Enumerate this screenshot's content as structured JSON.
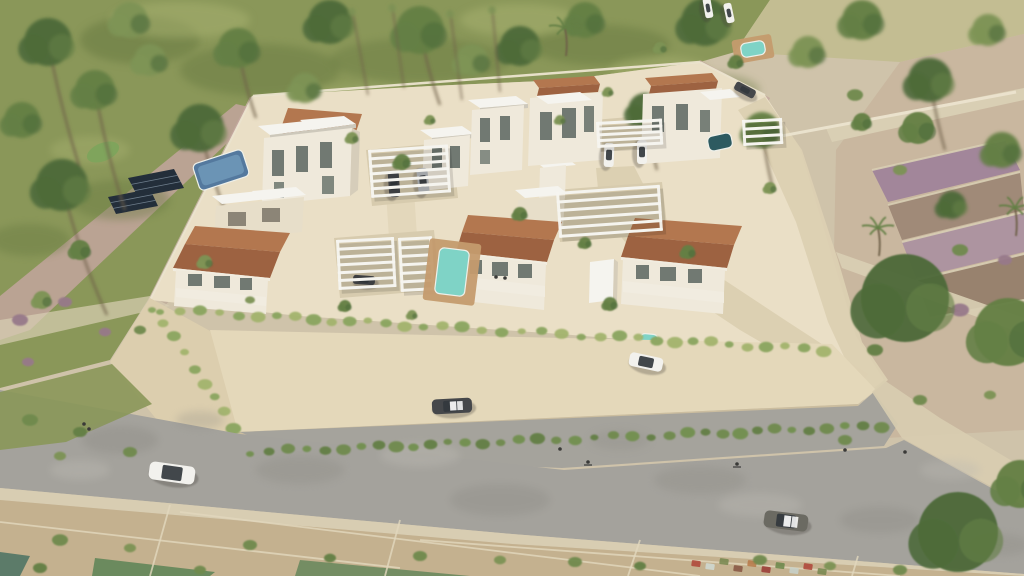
{
  "meta": {
    "scene_type": "architectural-aerial-render",
    "content_text": ""
  },
  "palette": {
    "base": "#cfc3aa",
    "grass": "#8a9759",
    "grassDark": "#66783f",
    "grassLight": "#a9b271",
    "dryField": "#c3bd92",
    "sand": "#c9b79f",
    "sandLight": "#d8cdb0",
    "dirt": "#bfae9b",
    "pink": "#c2a59e",
    "mauve": "#a2869a",
    "terraceBrown": "#a08a78",
    "terraceMauve": "#ad94a0",
    "terraceDark": "#98826e",
    "stone": "#d9cfb4",
    "platform": "#eadfc6",
    "pathLight": "#e3d7bb",
    "drivePath": "#dcd0b2",
    "pad": "#d7cbae",
    "wallCream": "#e4d8ba",
    "wallCreamDark": "#dcceae",
    "wallShade": "#c9bb9c",
    "road": "#a4a29c",
    "roadDark": "#8b8983",
    "roadLight": "#bcb9b2",
    "sidewalk": "#d8cdb2",
    "plots": "#c4b18f",
    "plotLine": "#e2d8be",
    "teal1": "#5c7b69",
    "teal2": "#6b8a5e",
    "white": "#f5f4ef",
    "slabShadow": "#cdc8bb",
    "wallWhite": "#efe9db",
    "wallSide": "#d6cdba",
    "win": "#5a655f",
    "tt": "#b3774f",
    "ttDark": "#9d6241",
    "eave": "#f1ece0",
    "cream": "#e7dec9",
    "door": "#8c8577",
    "poolBlue": "#54799e",
    "poolBlueIn": "#7099b8",
    "poolT": "#7fd3c6",
    "poolTDark": "#2d5a60",
    "deck": "#c49b6e",
    "treeDark": "#4d6a3a",
    "treeMid": "#647f45",
    "treeOlive": "#7d9355",
    "shrub": "#6f8a4e",
    "plant1": "#8aa55f",
    "plant2": "#a3b46d",
    "hedge": "#72904f",
    "trunk": "#6f5f49",
    "mauveShrub": "#97798a",
    "solar": "#232e3a",
    "carDark": "#45474a",
    "carSilver": "#b9bcc0",
    "carWhite": "#f2f1ed",
    "carGray": "#6b6a62",
    "cabin": "#33383d",
    "figure": "#3a3a38",
    "lawn": "#7fa45c"
  },
  "scene": {
    "bgTrees": [
      [
        48,
        42,
        24,
        "treeDark",
        40,
        150
      ],
      [
        22,
        120,
        18,
        "treeMid"
      ],
      [
        95,
        90,
        20,
        "treeMid",
        30,
        120
      ],
      [
        62,
        185,
        26,
        "treeDark",
        45,
        130
      ],
      [
        150,
        60,
        16,
        "treeOlive"
      ],
      [
        200,
        128,
        24,
        "treeDark",
        28,
        90
      ],
      [
        238,
        48,
        20,
        "treeMid",
        18,
        70
      ],
      [
        305,
        88,
        15,
        "treeOlive"
      ],
      [
        330,
        22,
        22,
        "treeDark"
      ],
      [
        420,
        30,
        24,
        "treeMid",
        20,
        75
      ],
      [
        472,
        60,
        16,
        "treeOlive"
      ],
      [
        520,
        46,
        20,
        "treeDark"
      ],
      [
        585,
        20,
        18,
        "treeMid"
      ],
      [
        645,
        110,
        17,
        "treeDark",
        12,
        60
      ],
      [
        705,
        22,
        24,
        "treeDark"
      ],
      [
        762,
        130,
        18,
        "treeMid",
        10,
        55
      ],
      [
        808,
        52,
        16,
        "treeOlive"
      ],
      [
        862,
        20,
        20,
        "treeMid"
      ],
      [
        930,
        80,
        22,
        "treeDark",
        15,
        70
      ],
      [
        988,
        30,
        16,
        "treeOlive"
      ],
      [
        1002,
        150,
        18,
        "treeMid"
      ],
      [
        952,
        205,
        14,
        "treeDark"
      ],
      [
        130,
        20,
        18,
        "treeOlive"
      ],
      [
        680,
        140,
        12,
        "treeOlive"
      ]
    ],
    "fgTrees": [
      [
        402,
        162,
        8,
        "treeMid"
      ],
      [
        352,
        138,
        6,
        "treeOlive"
      ],
      [
        430,
        120,
        5,
        "treeOlive"
      ],
      [
        520,
        214,
        7,
        "treeMid"
      ],
      [
        560,
        120,
        5,
        "treeOlive"
      ],
      [
        585,
        243,
        6,
        "treeMid"
      ],
      [
        688,
        252,
        7,
        "treeMid"
      ],
      [
        770,
        188,
        6,
        "treeOlive"
      ],
      [
        736,
        62,
        7,
        "treeMid"
      ],
      [
        660,
        48,
        6,
        "treeOlive"
      ],
      [
        608,
        92,
        5,
        "treeOlive"
      ],
      [
        345,
        306,
        6,
        "treeMid"
      ],
      [
        610,
        304,
        7,
        "treeMid"
      ],
      [
        412,
        315,
        5,
        "treeOlive"
      ],
      [
        905,
        298,
        44,
        "treeDark"
      ],
      [
        1008,
        332,
        34,
        "treeMid"
      ],
      [
        958,
        532,
        40,
        "treeDark"
      ],
      [
        1020,
        484,
        24,
        "treeMid"
      ],
      [
        862,
        122,
        9,
        "treeMid"
      ],
      [
        80,
        250,
        10,
        "treeMid"
      ],
      [
        42,
        300,
        9,
        "treeOlive"
      ],
      [
        205,
        262,
        7,
        "treeOlive"
      ],
      [
        918,
        128,
        16,
        "treeMid"
      ]
    ],
    "palms": [
      [
        565,
        28
      ],
      [
        878,
        228
      ],
      [
        1015,
        208
      ]
    ],
    "cypress": [
      [
        352,
        8,
        368,
        95
      ],
      [
        392,
        4,
        404,
        88
      ],
      [
        450,
        10,
        462,
        100
      ],
      [
        492,
        6,
        500,
        92
      ]
    ],
    "grassPatches": [
      [
        140,
        40,
        60,
        24,
        "grassDark",
        0.5
      ],
      [
        260,
        70,
        80,
        26,
        "grassDark",
        0.45
      ],
      [
        420,
        60,
        90,
        22,
        "grassDark",
        0.4
      ],
      [
        600,
        45,
        70,
        20,
        "grassDark",
        0.45
      ],
      [
        120,
        200,
        50,
        20,
        "grassDark",
        0.4
      ],
      [
        30,
        240,
        40,
        16,
        "grassDark",
        0.4
      ],
      [
        700,
        90,
        60,
        18,
        "grassDark",
        0.35
      ],
      [
        180,
        20,
        70,
        18,
        "grassLight",
        0.5
      ],
      [
        520,
        20,
        60,
        16,
        "grassLight",
        0.5
      ],
      [
        660,
        70,
        50,
        14,
        "grassLight",
        0.45
      ],
      [
        90,
        150,
        40,
        14,
        "grassLight",
        0.4
      ],
      [
        360,
        100,
        60,
        16,
        "grassLight",
        0.35
      ]
    ],
    "mottle": [
      [
        120,
        440,
        38,
        14,
        "roadDark",
        0.35
      ],
      [
        300,
        470,
        44,
        14,
        "roadDark",
        0.3
      ],
      [
        500,
        500,
        50,
        16,
        "roadDark",
        0.32
      ],
      [
        700,
        480,
        46,
        14,
        "roadDark",
        0.3
      ],
      [
        880,
        520,
        40,
        13,
        "roadDark",
        0.33
      ],
      [
        1000,
        545,
        30,
        11,
        "roadDark",
        0.3
      ],
      [
        200,
        420,
        24,
        9,
        "roadDark",
        0.25
      ],
      [
        620,
        440,
        30,
        10,
        "roadDark",
        0.25
      ],
      [
        420,
        455,
        40,
        12,
        "roadLight",
        0.4
      ],
      [
        760,
        505,
        42,
        12,
        "roadLight",
        0.38
      ],
      [
        950,
        470,
        30,
        10,
        "roadLight",
        0.35
      ],
      [
        80,
        470,
        30,
        10,
        "roadLight",
        0.4
      ]
    ],
    "wallPlantRows": [
      {
        "x1": 160,
        "y1": 306,
        "x2": 826,
        "y2": 346,
        "n": 36,
        "dy": 4
      },
      {
        "x1": 152,
        "y1": 306,
        "x2": 232,
        "y2": 426,
        "n": 9,
        "dy": 2
      }
    ],
    "hedgeRow": {
      "x1": 250,
      "y1": 452,
      "x2": 884,
      "y2": 426,
      "n": 36
    },
    "shrubs": [
      [
        60,
        540,
        8,
        "shrub"
      ],
      [
        130,
        548,
        6,
        "treeOlive"
      ],
      [
        250,
        545,
        7,
        "shrub"
      ],
      [
        330,
        558,
        6,
        "treeMid"
      ],
      [
        420,
        556,
        7,
        "shrub"
      ],
      [
        500,
        560,
        6,
        "treeOlive"
      ],
      [
        575,
        562,
        7,
        "shrub"
      ],
      [
        640,
        566,
        6,
        "treeMid"
      ],
      [
        760,
        560,
        7,
        "shrub"
      ],
      [
        830,
        566,
        6,
        "treeOlive"
      ],
      [
        900,
        570,
        7,
        "shrub"
      ],
      [
        40,
        568,
        7,
        "treeMid"
      ],
      [
        200,
        570,
        6,
        "shrub"
      ],
      [
        30,
        420,
        8,
        "shrub"
      ],
      [
        80,
        432,
        7,
        "treeMid"
      ],
      [
        130,
        452,
        7,
        "shrub"
      ],
      [
        60,
        456,
        6,
        "treeOlive"
      ],
      [
        855,
        95,
        8,
        "shrub"
      ],
      [
        900,
        170,
        7,
        "treeOlive"
      ],
      [
        960,
        250,
        8,
        "shrub"
      ],
      [
        875,
        350,
        8,
        "treeMid"
      ],
      [
        920,
        400,
        7,
        "shrub"
      ],
      [
        990,
        395,
        6,
        "treeOlive"
      ],
      [
        845,
        440,
        7,
        "shrub"
      ],
      [
        20,
        320,
        8,
        "mauveShrub"
      ],
      [
        65,
        302,
        7,
        "mauveShrub"
      ],
      [
        105,
        332,
        6,
        "mauveShrub"
      ],
      [
        140,
        330,
        6,
        "shrub"
      ],
      [
        28,
        362,
        6,
        "mauveShrub"
      ],
      [
        250,
        300,
        5,
        "treeOlive"
      ],
      [
        960,
        310,
        9,
        "mauveShrub"
      ],
      [
        1005,
        260,
        7,
        "mauveShrub"
      ]
    ],
    "clutter": [
      [
        692,
        560,
        "#b04a3c"
      ],
      [
        706,
        563,
        "#cfd8d0"
      ],
      [
        720,
        558,
        "#7a8a52"
      ],
      [
        734,
        565,
        "#8a5a46"
      ],
      [
        748,
        560,
        "#b87c4c"
      ],
      [
        762,
        566,
        "#9c3f38"
      ],
      [
        776,
        562,
        "#6f8a4e"
      ],
      [
        790,
        567,
        "#c8d0c8"
      ],
      [
        804,
        563,
        "#b04a3c"
      ],
      [
        818,
        568,
        "#7a8a52"
      ]
    ],
    "plotLines": [
      [
        0,
        522,
        400,
        568
      ],
      [
        180,
        512,
        700,
        576
      ],
      [
        420,
        540,
        900,
        576
      ],
      [
        170,
        505,
        150,
        576
      ],
      [
        400,
        520,
        385,
        576
      ],
      [
        640,
        540,
        628,
        576
      ],
      [
        858,
        556,
        852,
        576
      ]
    ],
    "boundaryLines": [
      [
        253,
        96,
        700,
        62,
        2.5
      ],
      [
        150,
        300,
        253,
        96,
        2
      ],
      [
        760,
        140,
        1016,
        92,
        3
      ],
      [
        700,
        62,
        765,
        95,
        2
      ]
    ],
    "terraceEdges": [
      [
        872,
        170,
        1005,
        140
      ],
      [
        888,
        205,
        1020,
        172
      ],
      [
        902,
        242,
        1024,
        212
      ],
      [
        916,
        280,
        1024,
        254
      ],
      [
        930,
        318,
        1024,
        300
      ]
    ],
    "pools": [
      {
        "x": 221,
        "y": 170,
        "w": 52,
        "h": 28,
        "a": -18,
        "f": "poolBlue",
        "in": "poolBlueIn",
        "name": "pool-neighbor"
      },
      {
        "x": 452,
        "y": 272,
        "w": 30,
        "h": 46,
        "a": 7,
        "f": "poolT",
        "deck": [
          52,
          62
        ],
        "name": "pool-center-villa"
      },
      {
        "x": 720,
        "y": 142,
        "w": 24,
        "h": 15,
        "a": -12,
        "f": "poolTDark",
        "name": "pool-back-right"
      },
      {
        "x": 753,
        "y": 49,
        "w": 24,
        "h": 14,
        "a": -10,
        "f": "poolT",
        "deck": [
          40,
          24
        ],
        "name": "pool-top-right"
      },
      {
        "x": 649,
        "y": 339,
        "w": 18,
        "h": 10,
        "a": 5,
        "f": "poolT",
        "name": "pool-front-small"
      }
    ],
    "pergolas": [
      {
        "x": 368,
        "y": 150,
        "w": 80,
        "h": 48,
        "n": 7,
        "a": -4
      },
      {
        "x": 336,
        "y": 240,
        "w": 58,
        "h": 50,
        "n": 7,
        "a": -3
      },
      {
        "x": 398,
        "y": 238,
        "w": 34,
        "h": 54,
        "n": 7,
        "a": -3
      },
      {
        "x": 556,
        "y": 192,
        "w": 104,
        "h": 46,
        "n": 6,
        "a": -4
      },
      {
        "x": 596,
        "y": 122,
        "w": 66,
        "h": 26,
        "n": 5,
        "a": -3
      },
      {
        "x": 742,
        "y": 120,
        "w": 40,
        "h": 26,
        "n": 4,
        "a": -3
      }
    ],
    "pergolaCars": [
      {
        "x": 394,
        "y": 184,
        "l": 26,
        "w": 11,
        "a": 86,
        "b": "carDark",
        "name": "car-dark-carport"
      },
      {
        "x": 423,
        "y": 181,
        "l": 26,
        "w": 11,
        "a": 84,
        "b": "carSilver",
        "name": "car-silver-carport"
      },
      {
        "x": 609,
        "y": 155,
        "l": 24,
        "w": 10,
        "a": 92,
        "b": "carWhite",
        "name": "car-white-carport-1"
      },
      {
        "x": 642,
        "y": 152,
        "l": 24,
        "w": 10,
        "a": 90,
        "b": "carWhite",
        "name": "car-white-carport-2"
      },
      {
        "x": 364,
        "y": 280,
        "l": 22,
        "w": 9,
        "a": 4,
        "b": "carDark",
        "name": "car-dark-front-carport"
      }
    ],
    "cars": [
      {
        "x": 172,
        "y": 473,
        "l": 46,
        "w": 18,
        "a": 8,
        "b": "carWhite",
        "name": "car-white-suv-road"
      },
      {
        "x": 452,
        "y": 406,
        "l": 40,
        "w": 15,
        "a": -3,
        "b": "carDark",
        "p": 1,
        "name": "car-dark-driveway"
      },
      {
        "x": 786,
        "y": 521,
        "l": 44,
        "w": 17,
        "a": 7,
        "b": "carGray",
        "p": 1,
        "name": "car-gray-sedan-road"
      },
      {
        "x": 646,
        "y": 362,
        "l": 34,
        "w": 14,
        "a": 12,
        "b": "carWhite",
        "name": "car-white-entrance-drive"
      },
      {
        "x": 745,
        "y": 90,
        "l": 22,
        "w": 9,
        "a": 28,
        "b": "carDark",
        "name": "car-dark-back-lane"
      },
      {
        "x": 708,
        "y": 8,
        "l": 20,
        "w": 8,
        "a": 80,
        "b": "carWhite",
        "name": "car-white-top-1"
      },
      {
        "x": 729,
        "y": 13,
        "l": 20,
        "w": 8,
        "a": 78,
        "b": "carWhite",
        "name": "car-white-top-2"
      }
    ],
    "people": [
      [
        84,
        424
      ],
      [
        89,
        429
      ],
      [
        560,
        449
      ],
      [
        588,
        462,
        1
      ],
      [
        737,
        464,
        1
      ],
      [
        845,
        450
      ],
      [
        905,
        452
      ],
      [
        496,
        277
      ],
      [
        505,
        278
      ]
    ],
    "solarPanels": [
      [
        [
          128,
          178
        ],
        [
          174,
          169
        ],
        [
          184,
          188
        ],
        [
          138,
          197
        ]
      ],
      [
        [
          108,
          197
        ],
        [
          150,
          189
        ],
        [
          158,
          206
        ],
        [
          116,
          214
        ]
      ]
    ]
  }
}
